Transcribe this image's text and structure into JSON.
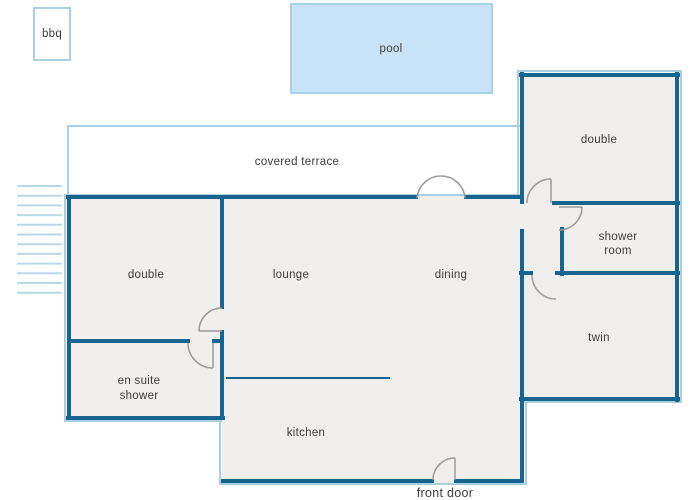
{
  "labels": {
    "bbq": "bbq",
    "pool": "pool",
    "covered_terrace": "covered terrace",
    "double_top": "double",
    "shower_line1": "shower",
    "shower_line2": "room",
    "twin": "twin",
    "double_left": "double",
    "ensuite_line1": "en suite",
    "ensuite_line2": "shower",
    "lounge": "lounge",
    "dining": "dining",
    "kitchen": "kitchen",
    "front_door": "front door"
  },
  "colors": {
    "wall": "#17648f",
    "light_accent": "#a8cfe2",
    "pool_fill": "#c8e3f5",
    "pool_border": "#a9d2e6",
    "room_fill": "#f0efee",
    "stairs": "#b9d9e8",
    "door_arc": "#9a9a9a",
    "text": "#3e3e3e"
  }
}
